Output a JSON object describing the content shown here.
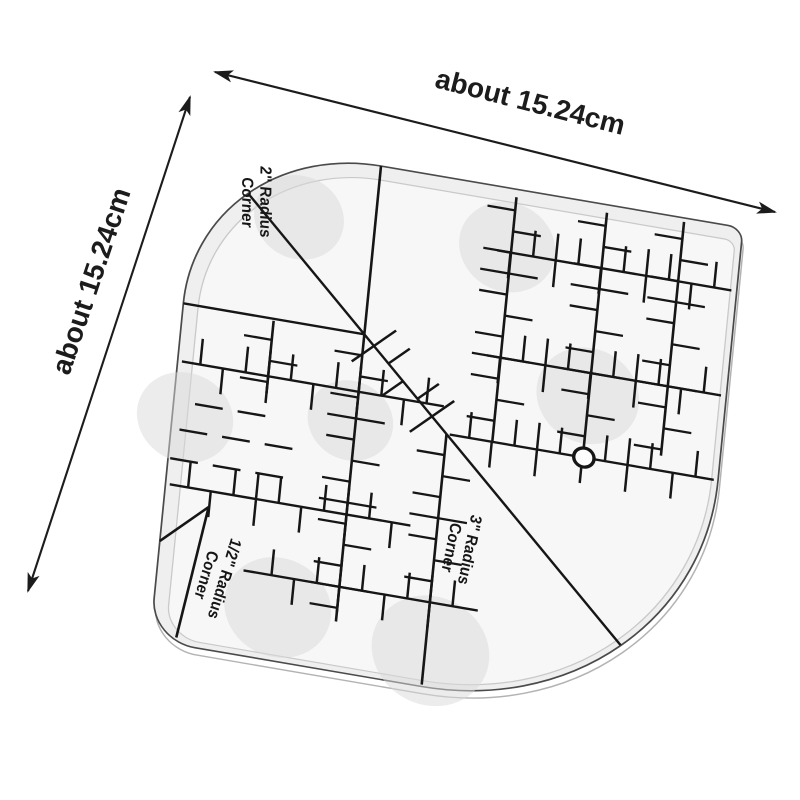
{
  "scene": {
    "background": "#ffffff"
  },
  "dimension_labels": {
    "top": "about 15.24cm",
    "left": "about 15.24cm"
  },
  "ruler": {
    "corner_labels": [
      {
        "id": "corner-2in",
        "line1": "2\" Radius",
        "line2": "Corner"
      },
      {
        "id": "corner-halfin",
        "line1": "1/2\" Radius",
        "line2": "Corner"
      },
      {
        "id": "corner-3in",
        "line1": "3\" Radius",
        "line2": "Corner"
      }
    ],
    "colors": {
      "marking": "#161616",
      "dimension": "#1c1c1c",
      "face": "#efefef",
      "face_inner": "#f7f7f7",
      "band_stroke": "#c9c9c9",
      "outline": "#4a4a4a",
      "edge_shadow": "#b3b3b3",
      "blob": "#d9d9d9"
    },
    "geometry_px": {
      "side": 510,
      "inch": 85,
      "tick_step": 21.25,
      "corner_radii": {
        "top_left": 170,
        "top_right": 14,
        "bottom_right": 255,
        "bottom_left": 42
      }
    },
    "hole": {
      "x": 384,
      "y": 255,
      "r": 9.5
    },
    "plain_lines": [
      [
        50,
        50,
        170,
        170
      ],
      [
        255,
        255,
        435,
        435
      ],
      [
        0,
        170,
        170,
        170
      ],
      [
        170,
        0,
        170,
        170
      ],
      [
        255,
        420,
        255,
        508
      ],
      [
        42,
        368,
        0,
        410
      ],
      [
        42,
        368,
        24,
        503
      ]
    ],
    "ticked_lines": [
      {
        "axis": "v",
        "at": 170,
        "from": 170,
        "to": 460
      },
      {
        "axis": "v",
        "at": 85,
        "from": 172,
        "to": 245
      },
      {
        "axis": "v",
        "at": 298,
        "from": 8,
        "to": 255
      },
      {
        "axis": "v",
        "at": 383,
        "from": 8,
        "to": 246
      },
      {
        "axis": "v",
        "at": 455,
        "from": 4,
        "to": 240
      },
      {
        "axis": "v",
        "at": 255,
        "from": 255,
        "to": 420
      },
      {
        "axis": "h",
        "at": 64,
        "from": 285,
        "to": 505
      },
      {
        "axis": "h",
        "at": 170,
        "from": 285,
        "to": 505
      },
      {
        "axis": "h",
        "at": 255,
        "from": 258,
        "to": 506
      },
      {
        "axis": "h",
        "at": 228,
        "from": 4,
        "to": 250
      },
      {
        "axis": "h",
        "at": 352,
        "from": 4,
        "to": 230
      },
      {
        "axis": "h",
        "at": 425,
        "from": 80,
        "to": 300
      },
      {
        "axis": "d",
        "x1": 170,
        "y1": 170,
        "x2": 255,
        "y2": 255
      }
    ],
    "edge_dashes": [
      [
        20,
        268,
        46,
        268
      ],
      [
        60,
        268,
        86,
        268
      ],
      [
        8,
        296,
        34,
        296
      ],
      [
        48,
        296,
        74,
        296
      ],
      [
        88,
        296,
        114,
        296
      ],
      [
        2,
        326,
        28,
        326
      ],
      [
        42,
        326,
        68,
        326
      ],
      [
        82,
        326,
        108,
        326
      ]
    ],
    "blobs": [
      [
        99,
        65,
        42
      ],
      [
        294,
        59,
        45
      ],
      [
        12,
        283,
        45
      ],
      [
        382,
        193,
        48
      ],
      [
        260,
        473,
        55
      ],
      [
        115,
        456,
        50
      ],
      [
        165,
        258,
        40
      ]
    ]
  }
}
